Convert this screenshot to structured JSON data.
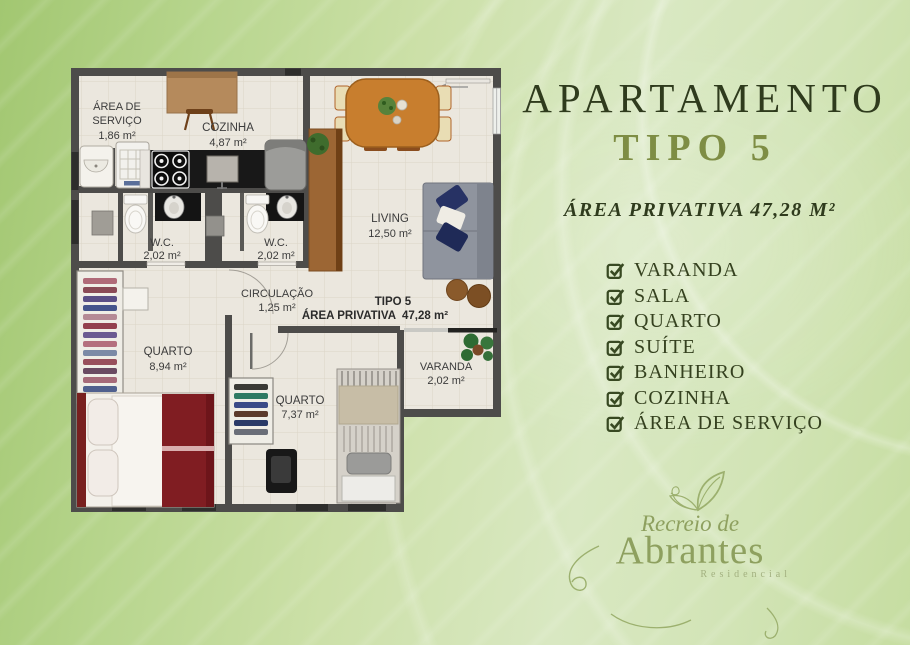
{
  "poster": {
    "title_line1": "APARTAMENTO",
    "title_line2": "TIPO 5",
    "subtitle": "ÁREA PRIVATIVA 47,28 M²",
    "features": [
      "VARANDA",
      "SALA",
      "QUARTO",
      "SUÍTE",
      "BANHEIRO",
      "COZINHA",
      "ÁREA DE SERVIÇO"
    ],
    "logo": {
      "top": "Recreio de",
      "main": "Abrantes",
      "tagline": "Residencial"
    }
  },
  "floor_plan": {
    "rooms": {
      "area_servico": {
        "name_line1": "ÁREA DE",
        "name_line2": "SERVIÇO",
        "area": "1,86 m²"
      },
      "cozinha": {
        "name": "COZINHA",
        "area": "4,87 m²"
      },
      "wc1": {
        "name": "W.C.",
        "area": "2,02 m²"
      },
      "wc2": {
        "name": "W.C.",
        "area": "2,02 m²"
      },
      "living": {
        "name": "LIVING",
        "area": "12,50 m²"
      },
      "circulacao": {
        "name": "CIRCULAÇÃO",
        "area": "1,25 m²"
      },
      "quarto1": {
        "name": "QUARTO",
        "area": "8,94 m²"
      },
      "quarto2": {
        "name": "QUARTO",
        "area": "7,37 m²"
      },
      "varanda": {
        "name": "VARANDA",
        "area": "2,02 m²"
      }
    },
    "tag": {
      "tipo": "TIPO 5",
      "area_label": "ÁREA PRIVATIVA",
      "area_value": "47,28 m²"
    }
  },
  "colors": {
    "title_dark_green": "#2f3b1d",
    "tipo_olive": "#7e8d44",
    "checklist_green": "#35411f",
    "logo_olive": "#8ea05f",
    "background_left": "#a2c771",
    "background_right": "#d9e8c2",
    "plan_wall": "#4d4c4a",
    "plan_floor": "#ebe7de",
    "bed_red": "#801d22",
    "pillow_navy": "#273264",
    "wood_orange": "#c87e2e"
  }
}
